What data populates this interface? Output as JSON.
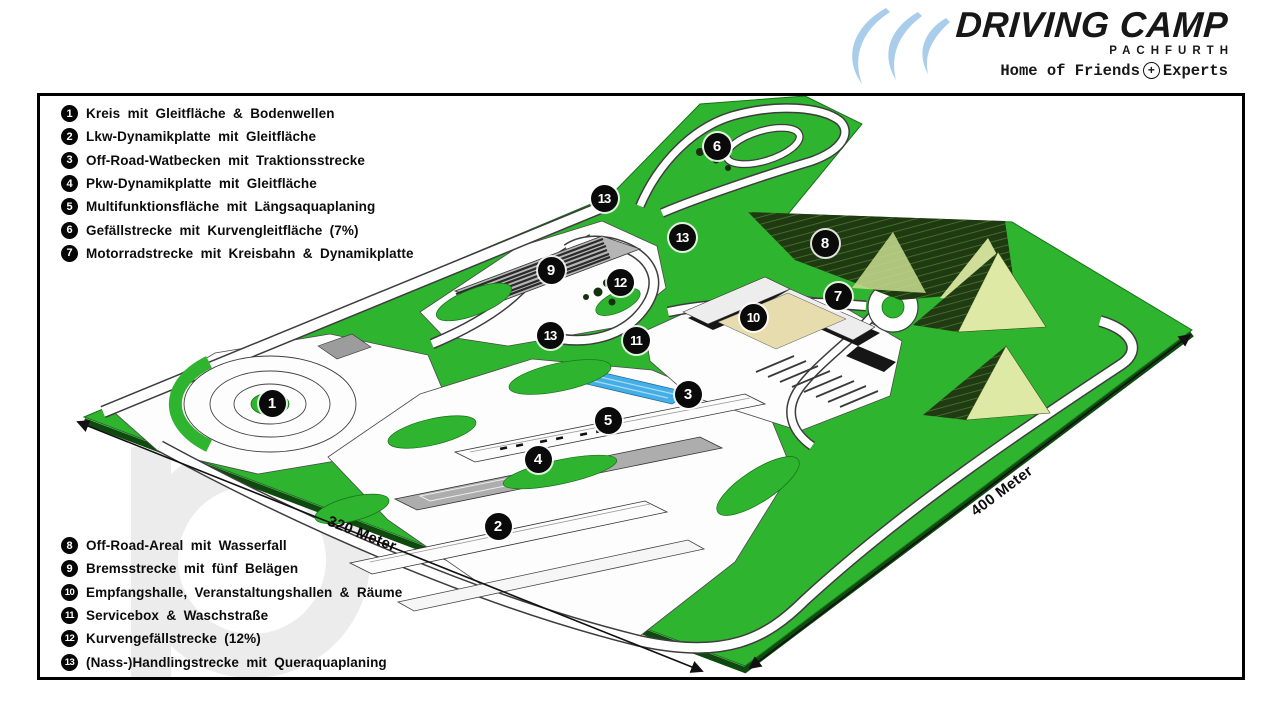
{
  "logo": {
    "brand": "DRIVING CAMP",
    "location": "PACHFURTH",
    "tagline": {
      "left": "Home of Friends",
      "plus": "+",
      "right": "Experts"
    },
    "swoosh_color": "#a9cdea"
  },
  "legend_top": {
    "items": [
      {
        "num": "1",
        "label": "Kreis mit Gleitfläche & Bodenwellen"
      },
      {
        "num": "2",
        "label": "Lkw-Dynamikplatte mit Gleitfläche"
      },
      {
        "num": "3",
        "label": "Off-Road-Watbecken mit Traktionsstrecke"
      },
      {
        "num": "4",
        "label": "Pkw-Dynamikplatte mit Gleitfläche"
      },
      {
        "num": "5",
        "label": "Multifunktionsfläche mit Längsaquaplaning"
      },
      {
        "num": "6",
        "label": "Gefällstrecke mit Kurvengleitfläche (7%)"
      },
      {
        "num": "7",
        "label": "Motorradstrecke mit Kreisbahn & Dynamikplatte"
      }
    ]
  },
  "legend_bottom": {
    "items": [
      {
        "num": "8",
        "label": "Off-Road-Areal mit Wasserfall"
      },
      {
        "num": "9",
        "label": "Bremsstrecke mit fünf Belägen"
      },
      {
        "num": "10",
        "label": "Empfangshalle, Veranstaltungshallen & Räume"
      },
      {
        "num": "11",
        "label": "Servicebox & Waschstraße"
      },
      {
        "num": "12",
        "label": "Kurvengefällstrecke (12%)"
      },
      {
        "num": "13",
        "label": "(Nass-)Handlingstrecke mit Queraquaplaning"
      }
    ]
  },
  "map": {
    "markers": [
      {
        "num": "1",
        "x": 272,
        "y": 403
      },
      {
        "num": "2",
        "x": 498,
        "y": 526
      },
      {
        "num": "3",
        "x": 688,
        "y": 394
      },
      {
        "num": "4",
        "x": 538,
        "y": 459
      },
      {
        "num": "5",
        "x": 608,
        "y": 420
      },
      {
        "num": "6",
        "x": 717,
        "y": 146
      },
      {
        "num": "7",
        "x": 838,
        "y": 296
      },
      {
        "num": "8",
        "x": 825,
        "y": 243
      },
      {
        "num": "9",
        "x": 551,
        "y": 270
      },
      {
        "num": "10",
        "x": 753,
        "y": 317
      },
      {
        "num": "11",
        "x": 636,
        "y": 340
      },
      {
        "num": "12",
        "x": 620,
        "y": 282
      },
      {
        "num": "13",
        "x": 604,
        "y": 198
      },
      {
        "num": "13",
        "x": 682,
        "y": 237
      },
      {
        "num": "13",
        "x": 550,
        "y": 335
      }
    ],
    "dimensions": [
      {
        "label": "320 Meter",
        "x": 362,
        "y": 534,
        "angle": 21.5
      },
      {
        "label": "400 Meter",
        "x": 1002,
        "y": 491,
        "angle": -37
      }
    ],
    "colors": {
      "grass": "#2eb42e",
      "water": "#45aee6",
      "hill_dark": "#1f3a12",
      "hill_light": "#dde9a4",
      "marker": "#0a0a0a"
    }
  }
}
